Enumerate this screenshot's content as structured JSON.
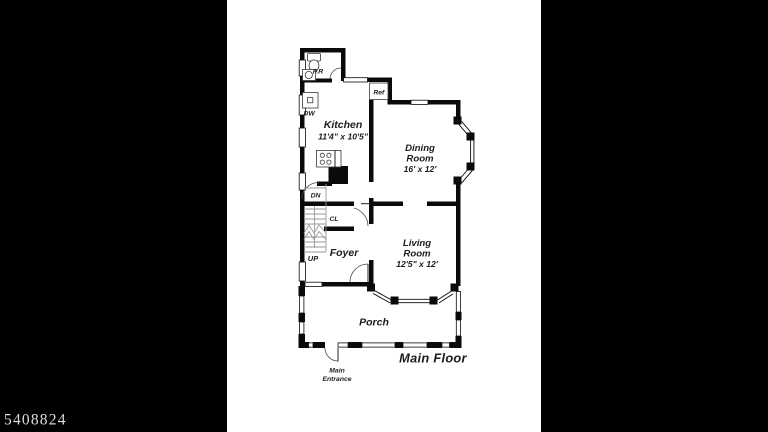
{
  "photo_id": "5408824",
  "plan": {
    "title": "Main Floor",
    "rooms": {
      "powder_room": {
        "name": "P.R"
      },
      "kitchen": {
        "name": "Kitchen",
        "dims": "11'4\" x 10'5\""
      },
      "dining": {
        "name_line1": "Dining",
        "name_line2": "Room",
        "dims": "16' x 12'"
      },
      "living": {
        "name_line1": "Living",
        "name_line2": "Room",
        "dims": "12'5\" x 12'"
      },
      "foyer": {
        "name": "Foyer"
      },
      "closet": {
        "name": "CL"
      },
      "porch": {
        "name": "Porch"
      }
    },
    "fixtures": {
      "dishwasher": "DW",
      "refrigerator": "Ref"
    },
    "stairs": {
      "down": "DN",
      "up": "UP"
    },
    "entrance": {
      "line1": "Main",
      "line2": "Entrance"
    }
  },
  "colors": {
    "matte": "#000000",
    "paper": "#ffffff",
    "wall": "#0a0a0a",
    "ink": "#1c1c1c",
    "photo_id": "#dedede"
  }
}
